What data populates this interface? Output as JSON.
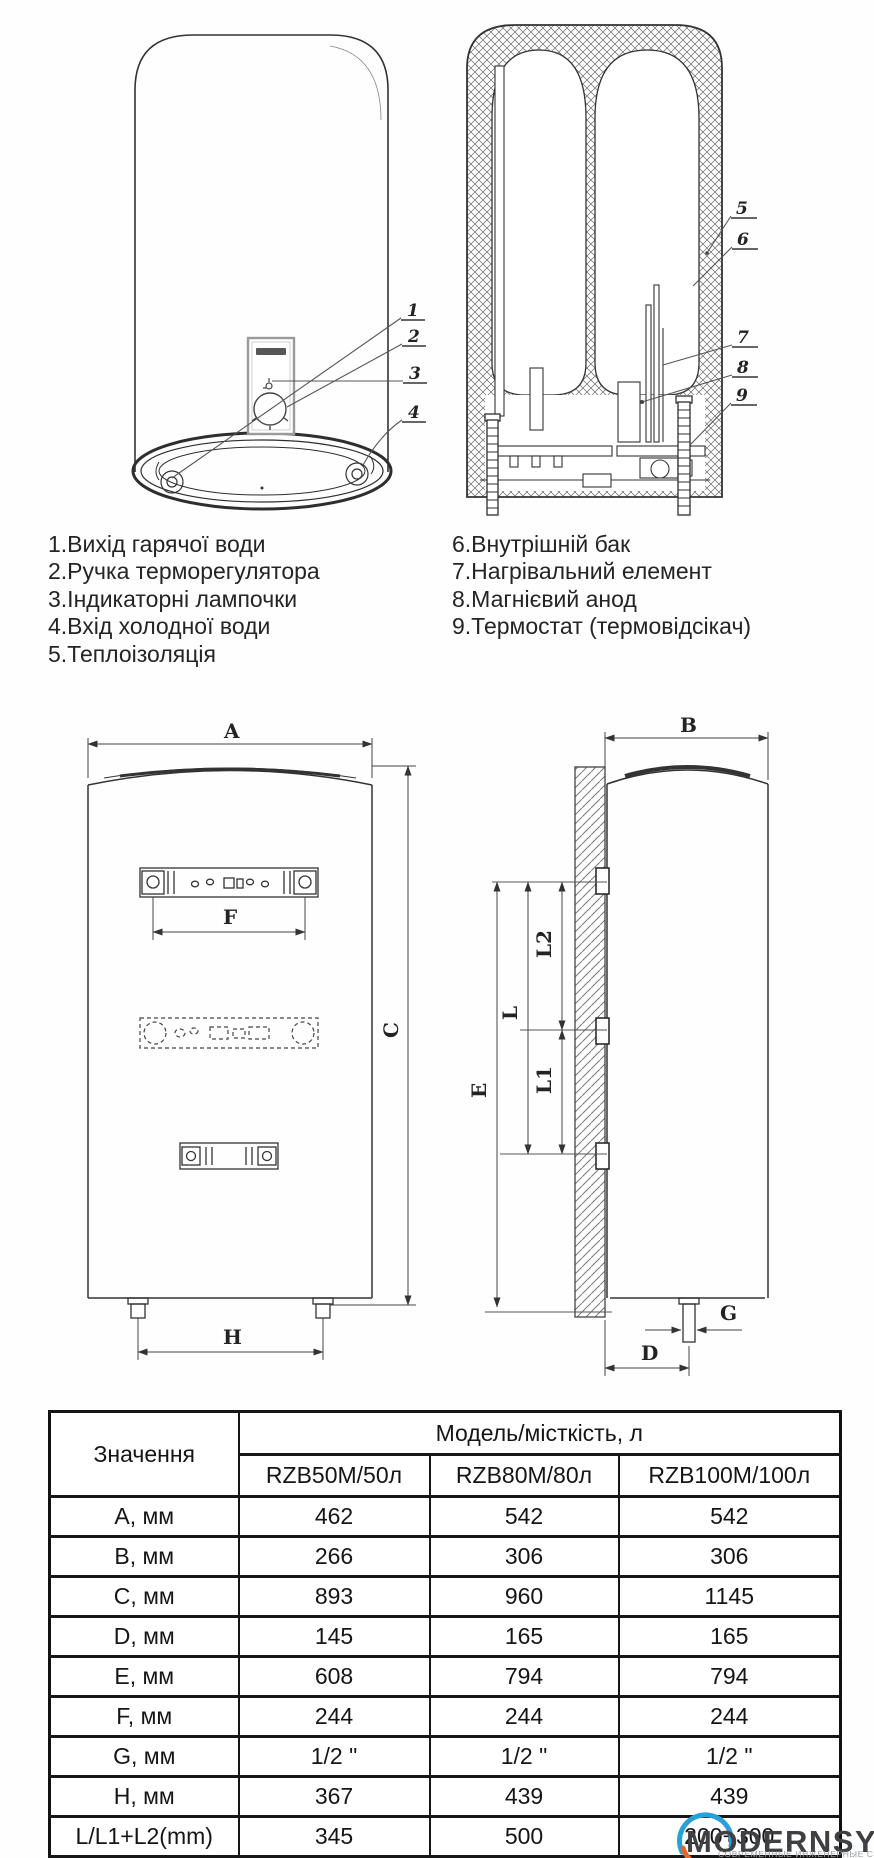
{
  "legend": {
    "left": [
      "1.Вихід гарячої води",
      "2.Ручка терморегулятора",
      "3.Індикаторні лампочки",
      "4.Вхід холодної води",
      "5.Теплоізоляція"
    ],
    "right": [
      "6.Внутрішній бак",
      "7.Нагрівальний елемент",
      "8.Магнієвий анод",
      "9.Термостат (термовідсікач)"
    ]
  },
  "callouts": {
    "c1": "1",
    "c2": "2",
    "c3": "3",
    "c4": "4",
    "c5": "5",
    "c6": "6",
    "c7": "7",
    "c8": "8",
    "c9": "9"
  },
  "dims": {
    "a": "A",
    "b": "B",
    "c": "C",
    "d": "D",
    "e": "E",
    "f": "F",
    "g": "G",
    "h": "H",
    "l": "L",
    "l1": "L1",
    "l2": "L2"
  },
  "table": {
    "col1_header": "Значення",
    "span_header": "Модель/місткість, л",
    "models": [
      "RZB50M/50л",
      "RZB80M/80л",
      "RZB100M/100л"
    ],
    "rows": [
      {
        "label": "A, мм",
        "values": [
          "462",
          "542",
          "542"
        ]
      },
      {
        "label": "B, мм",
        "values": [
          "266",
          "306",
          "306"
        ]
      },
      {
        "label": "C, мм",
        "values": [
          "893",
          "960",
          "1145"
        ]
      },
      {
        "label": "D, мм",
        "values": [
          "145",
          "165",
          "165"
        ]
      },
      {
        "label": "E, мм",
        "values": [
          "608",
          "794",
          "794"
        ]
      },
      {
        "label": "F, мм",
        "values": [
          "244",
          "244",
          "244"
        ]
      },
      {
        "label": "G, мм",
        "values": [
          "1/2 \"",
          "1/2 \"",
          "1/2 \""
        ]
      },
      {
        "label": "H, мм",
        "values": [
          "367",
          "439",
          "439"
        ]
      },
      {
        "label": "L/L1+L2(mm)",
        "values": [
          "345",
          "500",
          "200+300"
        ]
      }
    ]
  },
  "watermark": {
    "name": "MODERNSYS",
    "tagline": "СОВРЕМЕННЫЕ ИНЖЕНЕРНЫЕ СИСТЕМЫ",
    "blue": "#2aa0d8",
    "orange": "#e0662c"
  },
  "colors": {
    "line": "#333333",
    "table_border": "#161616",
    "text": "#1d1d1d"
  }
}
